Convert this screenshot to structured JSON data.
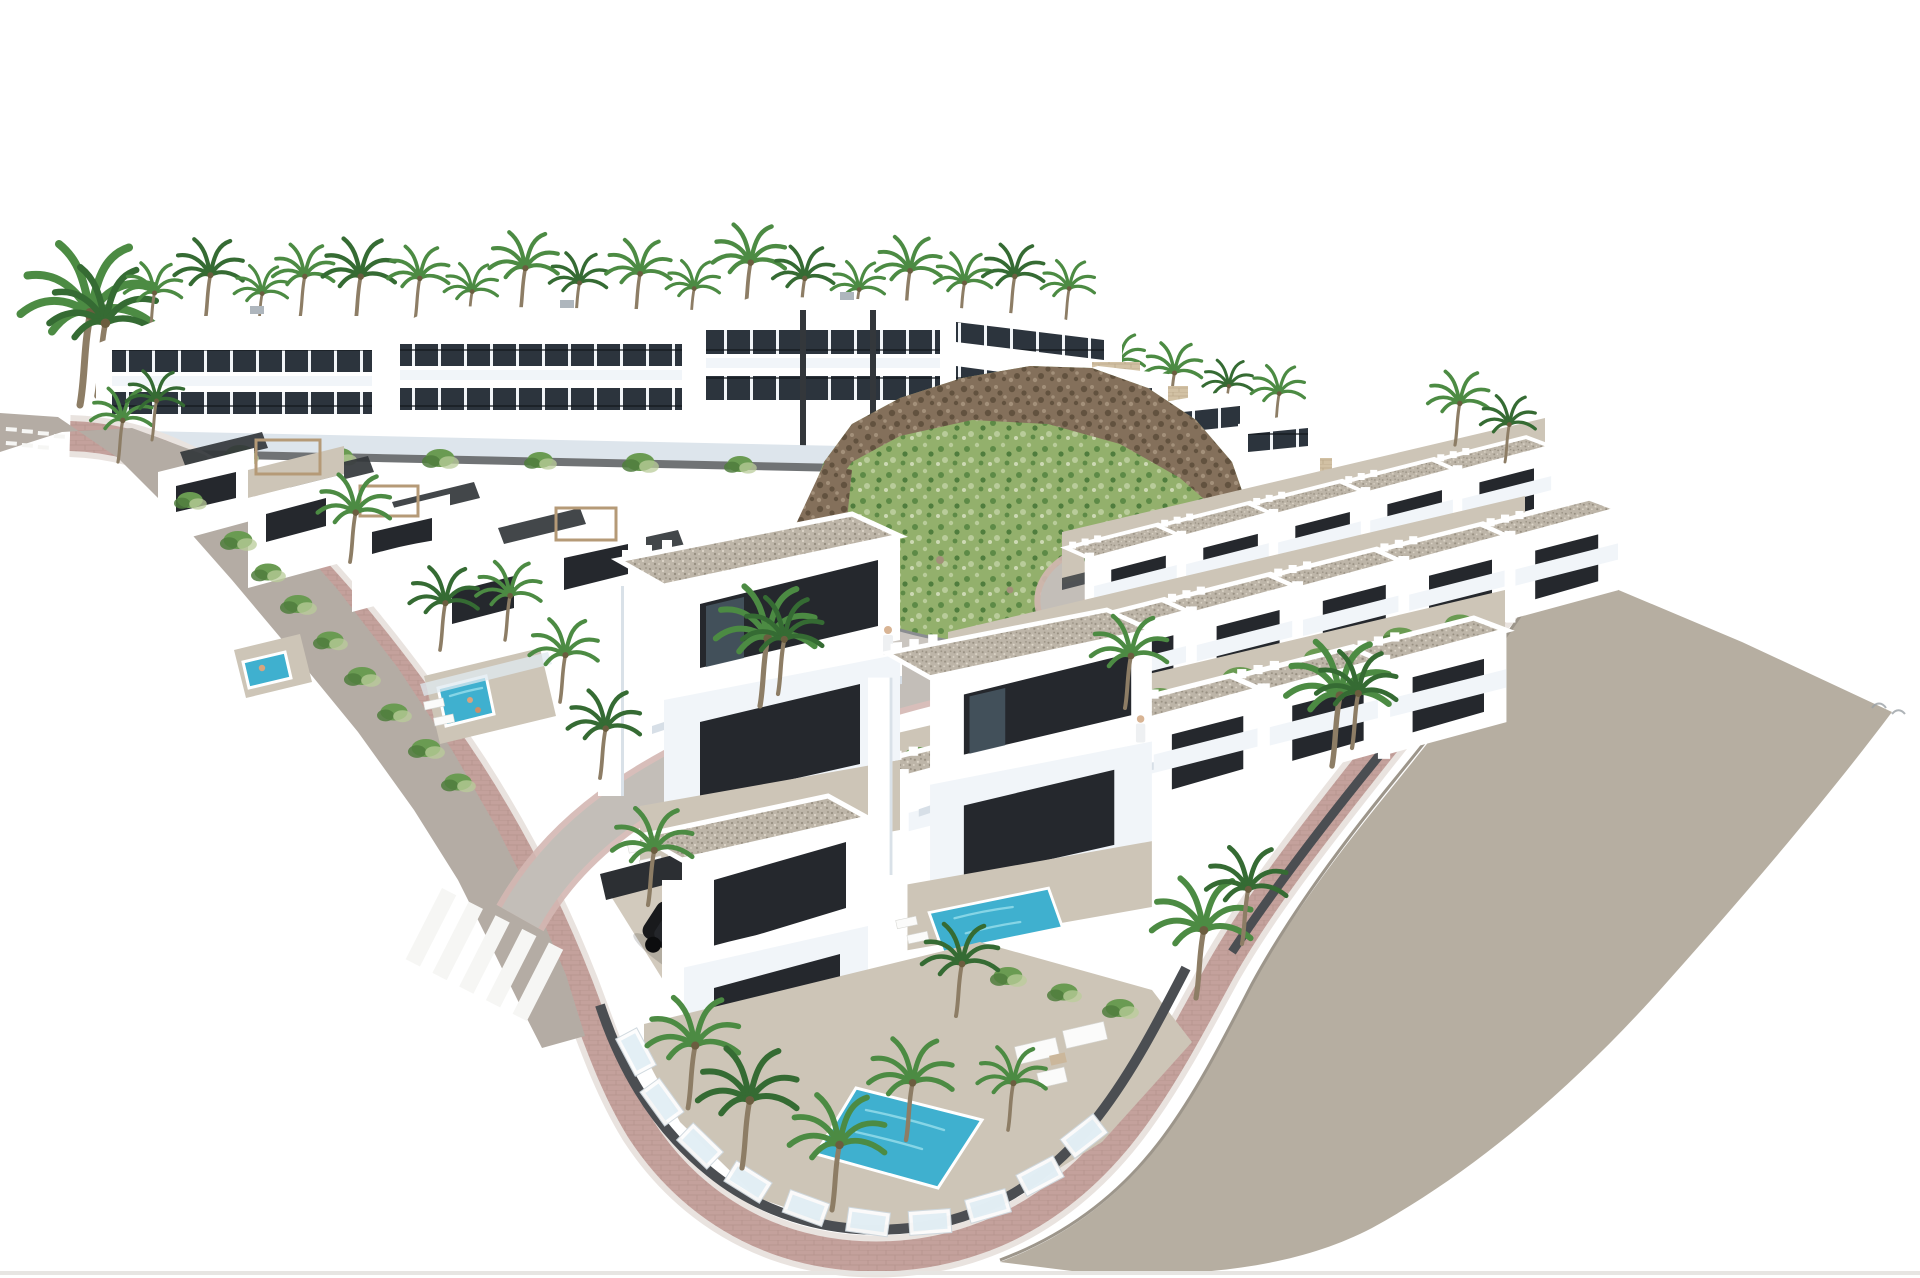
{
  "scene": {
    "type": "3d-architectural-render",
    "description": "Aerial 3D visualisation of a white modern villa development on a coastal hillside: a back row of terraced apartment blocks lined with palm trees, a rocky scrub-covered hill with a stepped stone boundary wall, three receding rows of white townhouses with gravel flat roofs and planted terraces, detached villas with roof pergolas and turquoise pools, curving grey roads edged with pink paved walkways, a zebra crossing, a black SUV and a white SUV parked by the foreground villas, a corner villa with pool and glass fence, a broad earth embankment on the right and two faint birds in the sky.",
    "background": "#ffffff"
  },
  "colors": {
    "background": "#ffffff",
    "wall_white": "#ffffff",
    "wall_tint": "#f1f5f9",
    "wall_shadow": "#dde5ec",
    "window_dark": "#25282d",
    "window_band": "#2c343d",
    "glass_blue": "#46545f",
    "dark_wall": "#33373b",
    "fence_wall": "#4b4e52",
    "gravel": "#bdb5a8",
    "gravel_dot_dark": "#978f81",
    "gravel_dot_light": "#ddd6c9",
    "terrace": "#cdc5b7",
    "asphalt": "#c3beb8",
    "asphalt_light": "#cac5bf",
    "road_taupe": "#b4aca4",
    "walk_pink": "#c4a19c",
    "walk_pink_light": "#d4b7b2",
    "kerb_light": "#e9e3df",
    "hill_green": "#93b06c",
    "hill_green_dark": "#5d8a46",
    "hill_green_light": "#b9cc9a",
    "rock_brown": "#84705b",
    "rock_dark": "#62523f",
    "rock_light": "#a3907a",
    "stone_wall": "#d2c1a4",
    "stone_line": "#b5a285",
    "embankment": "#b6aea1",
    "pool": "#3fb0cf",
    "pool_light": "#8ed9e8",
    "pool_dark": "#2a92b4",
    "palm_green": "#4c8b43",
    "palm_green_dark": "#356b33",
    "palm_trunk": "#8d7d65",
    "shrub_green": "#6a9b52",
    "shrub_dark": "#4f7d3d",
    "car_black": "#191a1c",
    "car_white": "#f0f1f2",
    "car_glass": "#97a3ac",
    "stripe_white": "#f6f6f4",
    "bird_grey": "#9aa0a5",
    "bottom_strip": "#e7e5e2"
  },
  "inventory": {
    "apartment_blocks": 4,
    "hilltop_houses": 3,
    "rowhouse_rows": 3,
    "rowhouses_per_row": [
      5,
      6,
      5
    ],
    "foreground_villas": 3,
    "detached_villas": 6,
    "pools": 4,
    "pergolas": 4,
    "palm_trees": 40,
    "vehicles": [
      {
        "type": "suv",
        "color": "black"
      },
      {
        "type": "suv",
        "color": "white"
      }
    ],
    "roads": [
      "perimeter-road",
      "interior-street",
      "cul-de-sac",
      "hill-base-road"
    ],
    "walkways": [
      "pink-paved-perimeter-walkway"
    ],
    "crosswalk_stripes": 5,
    "birds": 2
  }
}
